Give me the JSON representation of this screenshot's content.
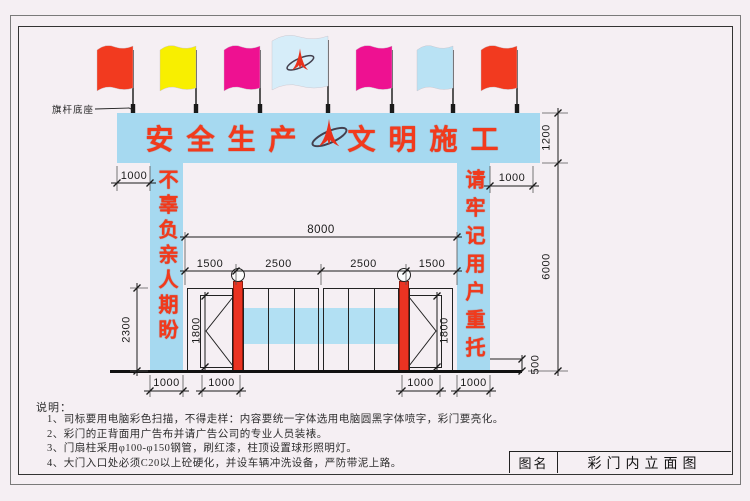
{
  "drawing": {
    "banner": {
      "text_left": "安全生产",
      "text_right": "文明施工"
    },
    "flag_base_label": "旗杆底座",
    "left_column_text": "不辜负亲人期盼",
    "right_column_text": "请牢记用户重托",
    "flags": [
      {
        "name": "red-flag",
        "color": "#f23a1f"
      },
      {
        "name": "yellow-flag",
        "color": "#f8ef00"
      },
      {
        "name": "magenta-flag",
        "color": "#ee1191"
      },
      {
        "name": "logo-flag",
        "color": "#d6edf9"
      },
      {
        "name": "magenta-flag",
        "color": "#ee1191"
      },
      {
        "name": "lightblue-flag",
        "color": "#b9e2f4"
      },
      {
        "name": "red-flag",
        "color": "#f23a1f"
      }
    ],
    "dims": {
      "banner_height": "1200",
      "structure_height": "6000",
      "curb_height": "500",
      "gate_height": "2300",
      "door_height_left": "1800",
      "door_height_right": "1800",
      "opening_width": "8000",
      "seg1": "1500",
      "seg2": "2500",
      "seg3": "2500",
      "seg4": "1500",
      "banner_overhang_left": "1000",
      "banner_overhang_right": "1000",
      "col_width_left": "1000",
      "door_width_left": "1000",
      "door_width_right": "1000",
      "col_width_right": "1000"
    }
  },
  "notes": {
    "heading": "说明：",
    "items": [
      "1、司标要用电脑彩色扫描，不得走样：内容要统一字体选用电脑圆黑字体喷字，彩门要亮化。",
      "2、彩门的正背面用广告布并请广告公司的专业人员装裱。",
      "3、门扇柱采用φ100-φ150钢管，刷红漆，柱顶设置球形照明灯。",
      "4、大门入口处必须C20以上砼硬化，并设车辆冲洗设备，严防带泥上路。"
    ]
  },
  "title_block": {
    "label": "图名",
    "value": "彩门内立面图"
  },
  "colors": {
    "banner_blue": "#a6d9f0",
    "accent_red": "#f23a1c",
    "post_red": "#ea3322",
    "line": "#222222"
  }
}
